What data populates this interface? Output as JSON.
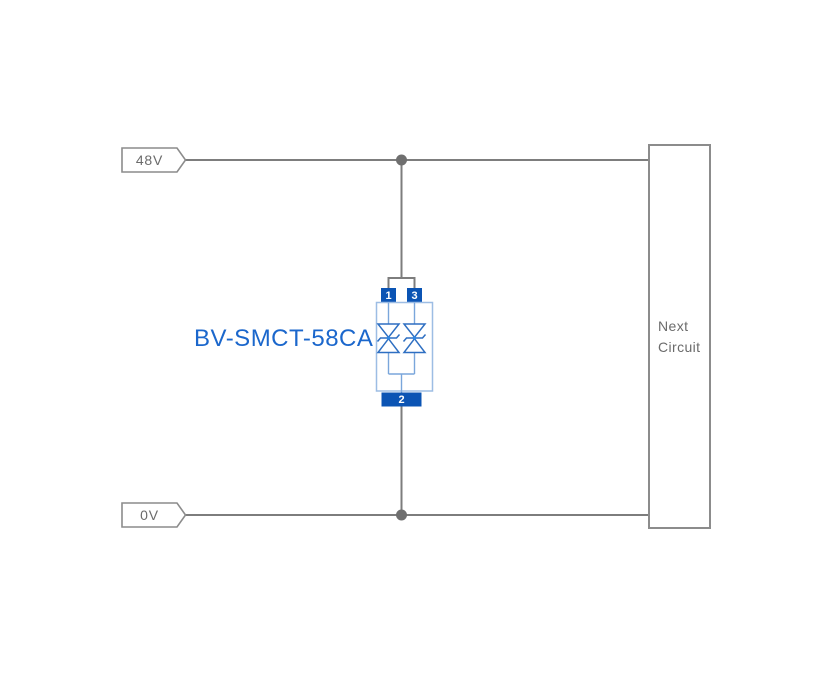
{
  "labels": {
    "top_rail": "48V",
    "bottom_rail": "0V",
    "component": "BV-SMCT-58CA",
    "next_circuit_line1": "Next",
    "next_circuit_line2": "Circuit",
    "pin_top_left": "1",
    "pin_top_right": "3",
    "pin_bottom": "2"
  },
  "colors": {
    "background": "#ffffff",
    "wire": "#7d7d7d",
    "junction_dot": "#6f6f6f",
    "tag_border": "#8c8c8c",
    "label_text": "#6b6b6b",
    "component_text": "#1b67cc",
    "pad_fill": "#0b54b4",
    "body_outline": "#9dbde4",
    "inner_line": "#7aa6db",
    "diode_stroke": "#2e6fc2",
    "diode_dot": "#2f86e2"
  }
}
